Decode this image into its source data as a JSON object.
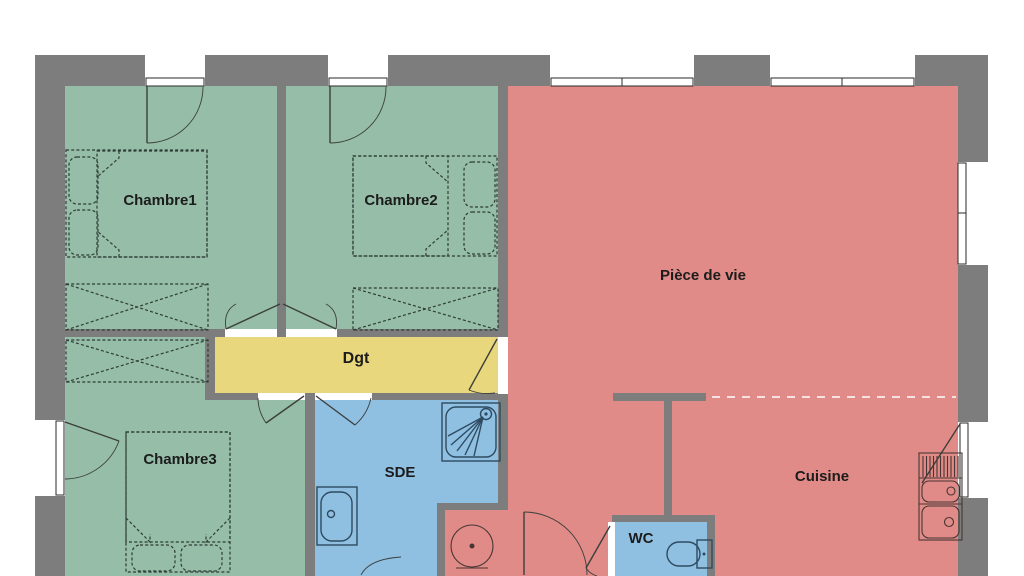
{
  "plan": {
    "labels": {
      "chambre1": "Chambre1",
      "chambre2": "Chambre2",
      "chambre3": "Chambre3",
      "piece_de_vie": "Pièce de vie",
      "dgt": "Dgt",
      "sde": "SDE",
      "cuisine": "Cuisine",
      "wc": "WC"
    },
    "colors": {
      "wall": "#7d7d7d",
      "bedroom_fill": "#95bda7",
      "living_fill": "#e08b87",
      "corridor_fill": "#e8d77c",
      "water_fill": "#8fc0e2",
      "opening": "#ffffff",
      "background": "#ffffff"
    }
  }
}
